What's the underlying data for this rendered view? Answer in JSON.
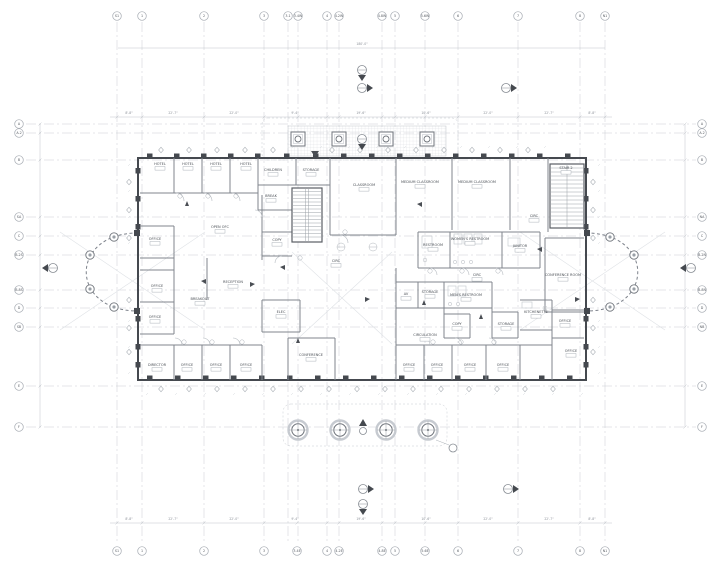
{
  "drawing": {
    "kind": "architectural floor plan",
    "colors": {
      "wall": "#45494f",
      "partition": "#80858d",
      "grid_line": "#c9ccd2",
      "dimension": "#c0c4ca",
      "label_text": "#4c5157",
      "hatch": "#d4d7dc",
      "background": "#ffffff"
    }
  },
  "grid": {
    "top": [
      "S1",
      "1",
      "2",
      "3",
      "3.1",
      "3.4W",
      "4",
      "4.2W",
      "4.8W",
      "5",
      "5.6W",
      "6",
      "7",
      "8",
      "N1"
    ],
    "bottom": [
      "S1",
      "1",
      "2",
      "3",
      "3.4E",
      "4",
      "4.2E",
      "4.8E",
      "5",
      "5.6E",
      "6",
      "7",
      "8",
      "N1"
    ],
    "left": [
      "A",
      "A.2",
      "B",
      "SA",
      "C",
      "B.2S",
      "B.8S",
      "D",
      "SB",
      "E",
      "F"
    ],
    "right": [
      "A",
      "A.2",
      "B",
      "NA",
      "C",
      "B.2N",
      "B.8N",
      "D",
      "NB",
      "E",
      "F"
    ]
  },
  "rooms": [
    "HOTEL",
    "HOTEL",
    "HOTEL",
    "HOTEL",
    "CHILDREN",
    "STORAGE",
    "BREAK",
    "CLASSROOM",
    "MEDIUM CLASSROOM",
    "MEDIUM CLASSROOM",
    "STAIR 2",
    "CIRC",
    "OPEN OFC",
    "OFFICE",
    "COPY",
    "RESTROOM",
    "WOMEN'S RESTROOM",
    "JANITOR",
    "CIRC",
    "CONFERENCE ROOM",
    "OFFICE",
    "RECEPTION",
    "BREAKOUT",
    "ELEC",
    "OFFICE",
    "AV",
    "STORAGE",
    "MEN'S RESTROOM",
    "CIRC",
    "KITCHENETTE",
    "OFFICE",
    "CIRCULATION",
    "COPY",
    "STORAGE",
    "CONFERENCE",
    "DIRECTOR",
    "OFFICE",
    "OFFICE",
    "OFFICE",
    "OFFICE",
    "OFFICE",
    "OFFICE",
    "OFFICE",
    "OFFICE"
  ],
  "dimensions": {
    "overall_top": "180'-0\"",
    "top_row": [
      "8'-8\"",
      "22'-7\"",
      "22'-0\"",
      "9'-4\"",
      "19'-6\"",
      "10'-6\"",
      "22'-0\"",
      "22'-7\"",
      "8'-8\""
    ],
    "bottom_row": [
      "8'-8\"",
      "22'-7\"",
      "22'-0\"",
      "9'-4\"",
      "19'-6\"",
      "10'-6\"",
      "22'-0\"",
      "22'-7\"",
      "8'-8\""
    ]
  }
}
